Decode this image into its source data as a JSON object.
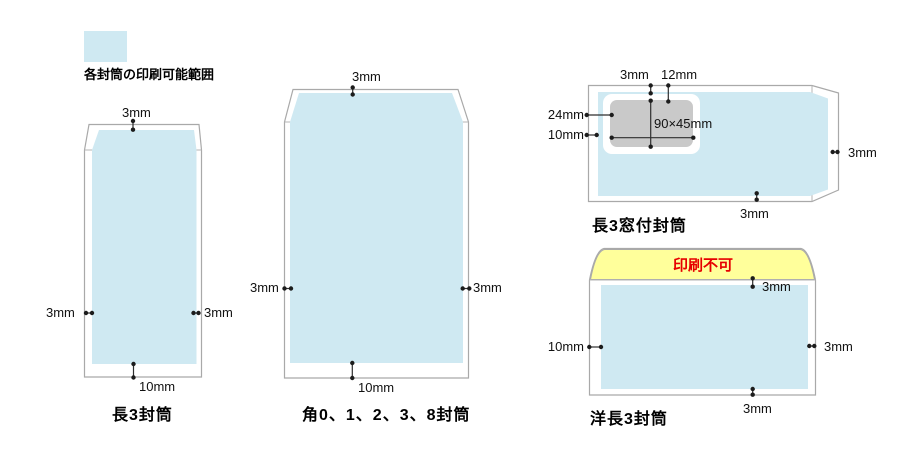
{
  "colors": {
    "printable_area_blue": "#cfe9f2",
    "window_gray": "#c9c9c9",
    "flap_yellow": "#ffff9b",
    "no_print_red": "#e60000",
    "outline_gray": "#a9a9a9"
  },
  "legend": {
    "label": "各封筒の印刷可能範囲"
  },
  "envelopes": {
    "naga3": {
      "title": "長3封筒",
      "margin_top": "3mm",
      "margin_left": "3mm",
      "margin_right": "3mm",
      "margin_bottom": "10mm"
    },
    "kaku": {
      "title": "角0、1、2、3、8封筒",
      "margin_top": "3mm",
      "margin_left": "3mm",
      "margin_right": "3mm",
      "margin_bottom": "10mm"
    },
    "naga3mado": {
      "title": "長3窓付封筒",
      "margin_top": "3mm",
      "window_offset_top": "12mm",
      "window_offset_left": "24mm",
      "margin_left": "10mm",
      "window_size": "90×45mm",
      "margin_right": "3mm",
      "margin_bottom": "3mm"
    },
    "yonaga3": {
      "title": "洋長3封筒",
      "flap_warning": "印刷不可",
      "margin_top": "3mm",
      "margin_left": "10mm",
      "margin_right": "3mm",
      "margin_bottom": "3mm"
    }
  }
}
